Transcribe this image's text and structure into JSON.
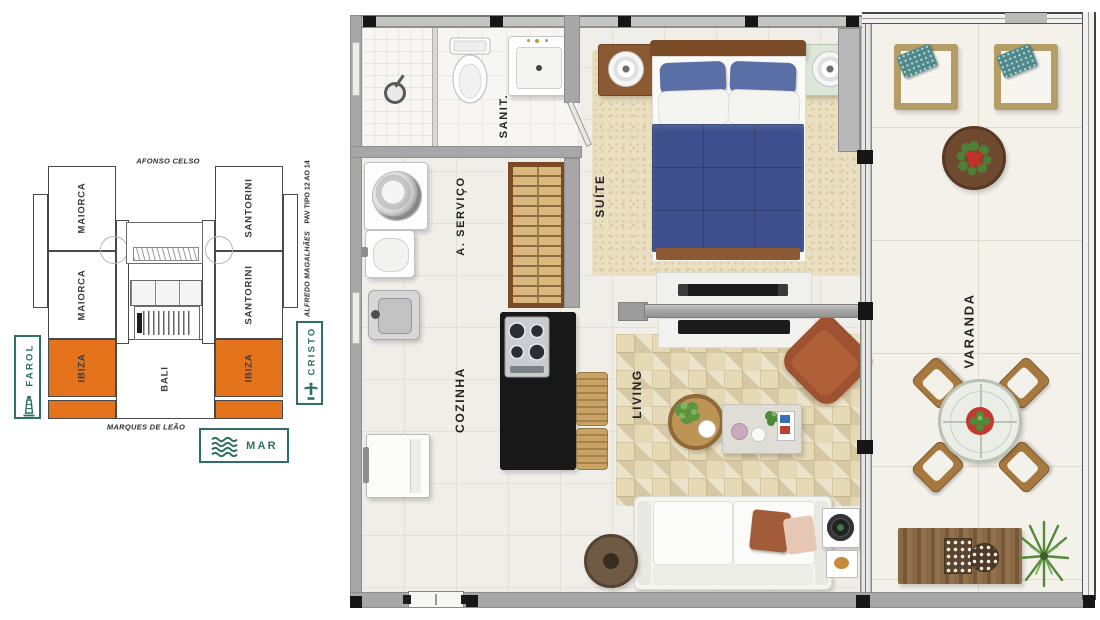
{
  "keyplan": {
    "street_top": "AFONSO CELSO",
    "street_bottom": "MARQUES DE LEÃO",
    "street_right": "ALFREDO MAGALHÃES",
    "floor_note": "PAV TIPO 12 AO 14",
    "units": {
      "maiorca": "MAIORCA",
      "santorini": "SANTORINI",
      "ibiza": "IBIZA",
      "bali": "BALI"
    },
    "badges": {
      "farol": "FAROL",
      "cristo": "CRISTO",
      "mar": "MAR"
    },
    "colors": {
      "highlight_orange": "#E5731C",
      "badge_teal": "#2E7164"
    }
  },
  "floorplan": {
    "rooms": {
      "sanit": "SANIT.",
      "servico": "A. SERVIÇO",
      "suite": "SUÍTE",
      "cozinha": "COZINHA",
      "living": "LIVING",
      "varanda": "VARANDA"
    }
  }
}
